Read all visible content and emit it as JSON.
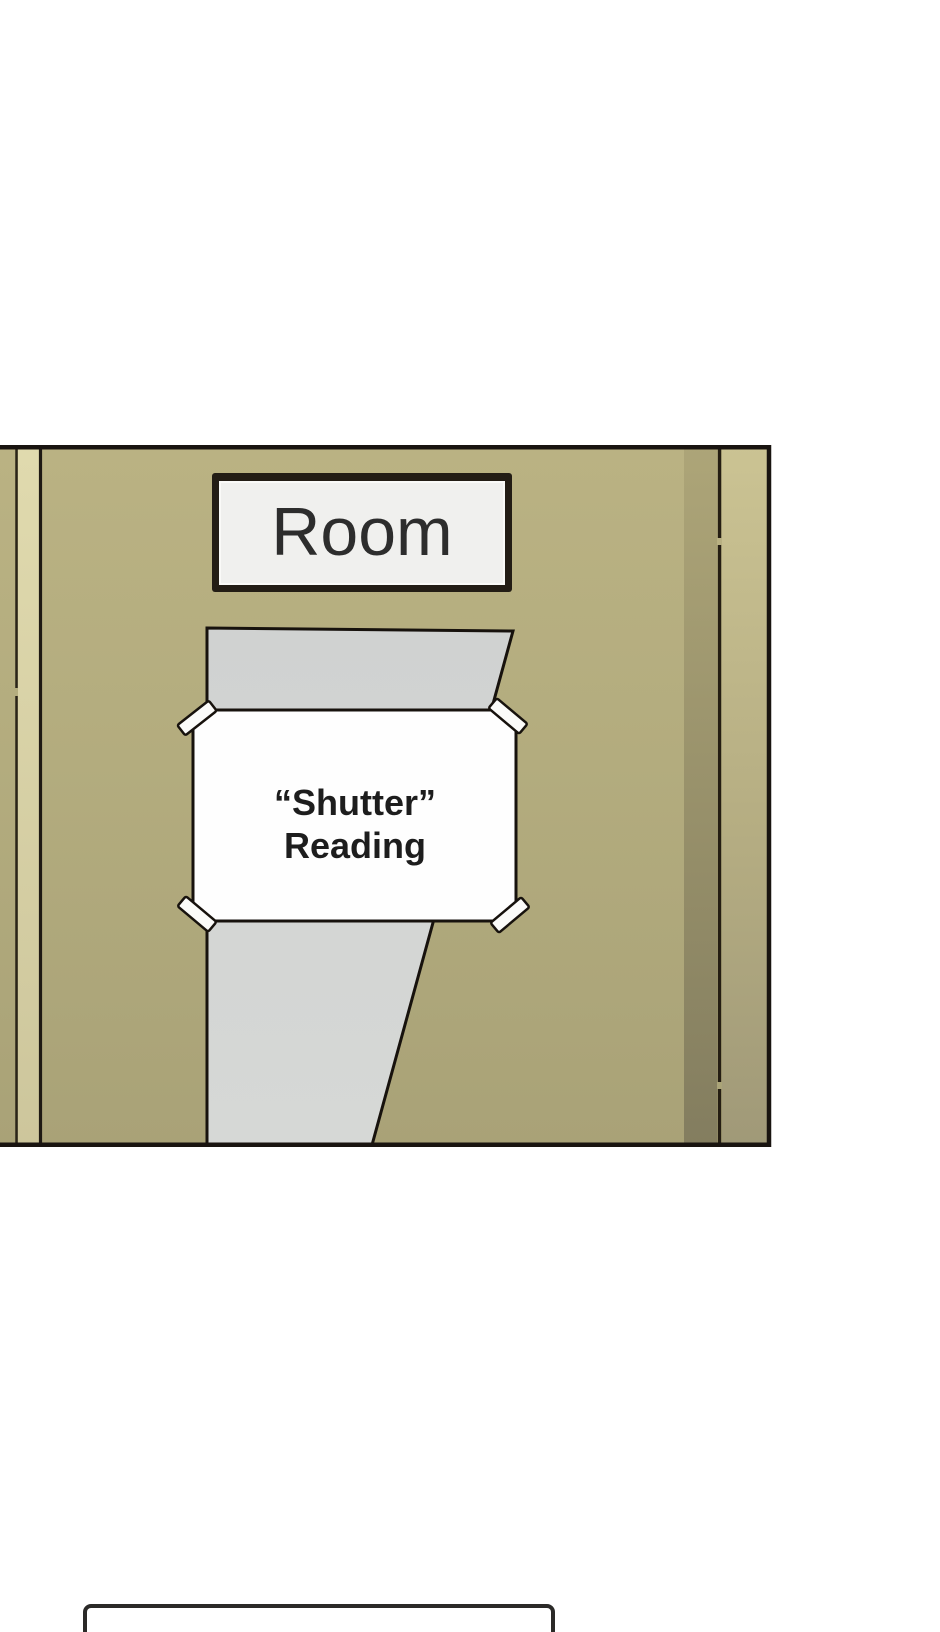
{
  "panel": {
    "door_name_plate": {
      "label": "Room"
    },
    "paper_notice": {
      "line1": "“Shutter”",
      "line2": "Reading"
    }
  },
  "colors": {
    "door_khaki": "#b3ac7e",
    "window_gray": "#d4d6d4",
    "paper_white": "#fefefe",
    "plate_white": "#f0f0ee",
    "outline_black": "#17120d",
    "frame_dark": "#231d15",
    "tape_white": "#fbfbf9"
  }
}
